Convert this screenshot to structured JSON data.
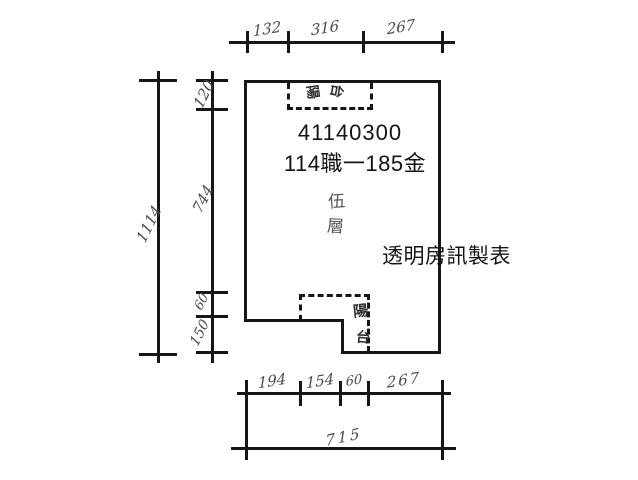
{
  "plan": {
    "unit_code": "41140300",
    "unit_name": "114職一185金",
    "floor_label": {
      "char1": "伍",
      "char2": "層"
    },
    "watermark": "透明房訊製表",
    "balcony_top": {
      "char1": "陽",
      "char2": "台"
    },
    "balcony_bottom": {
      "char1": "陽",
      "char2": "台"
    }
  },
  "dimensions": {
    "top_segments": [
      "132",
      "316",
      "267"
    ],
    "left_total": "1114",
    "left_segments": [
      "120",
      "744",
      "60",
      "150"
    ],
    "bottom_segments": [
      "194",
      "154",
      "60",
      "267"
    ],
    "bottom_total": "715"
  },
  "colors": {
    "line": "#161616",
    "handwriting": "#4a4a4a",
    "print": "#141414"
  }
}
